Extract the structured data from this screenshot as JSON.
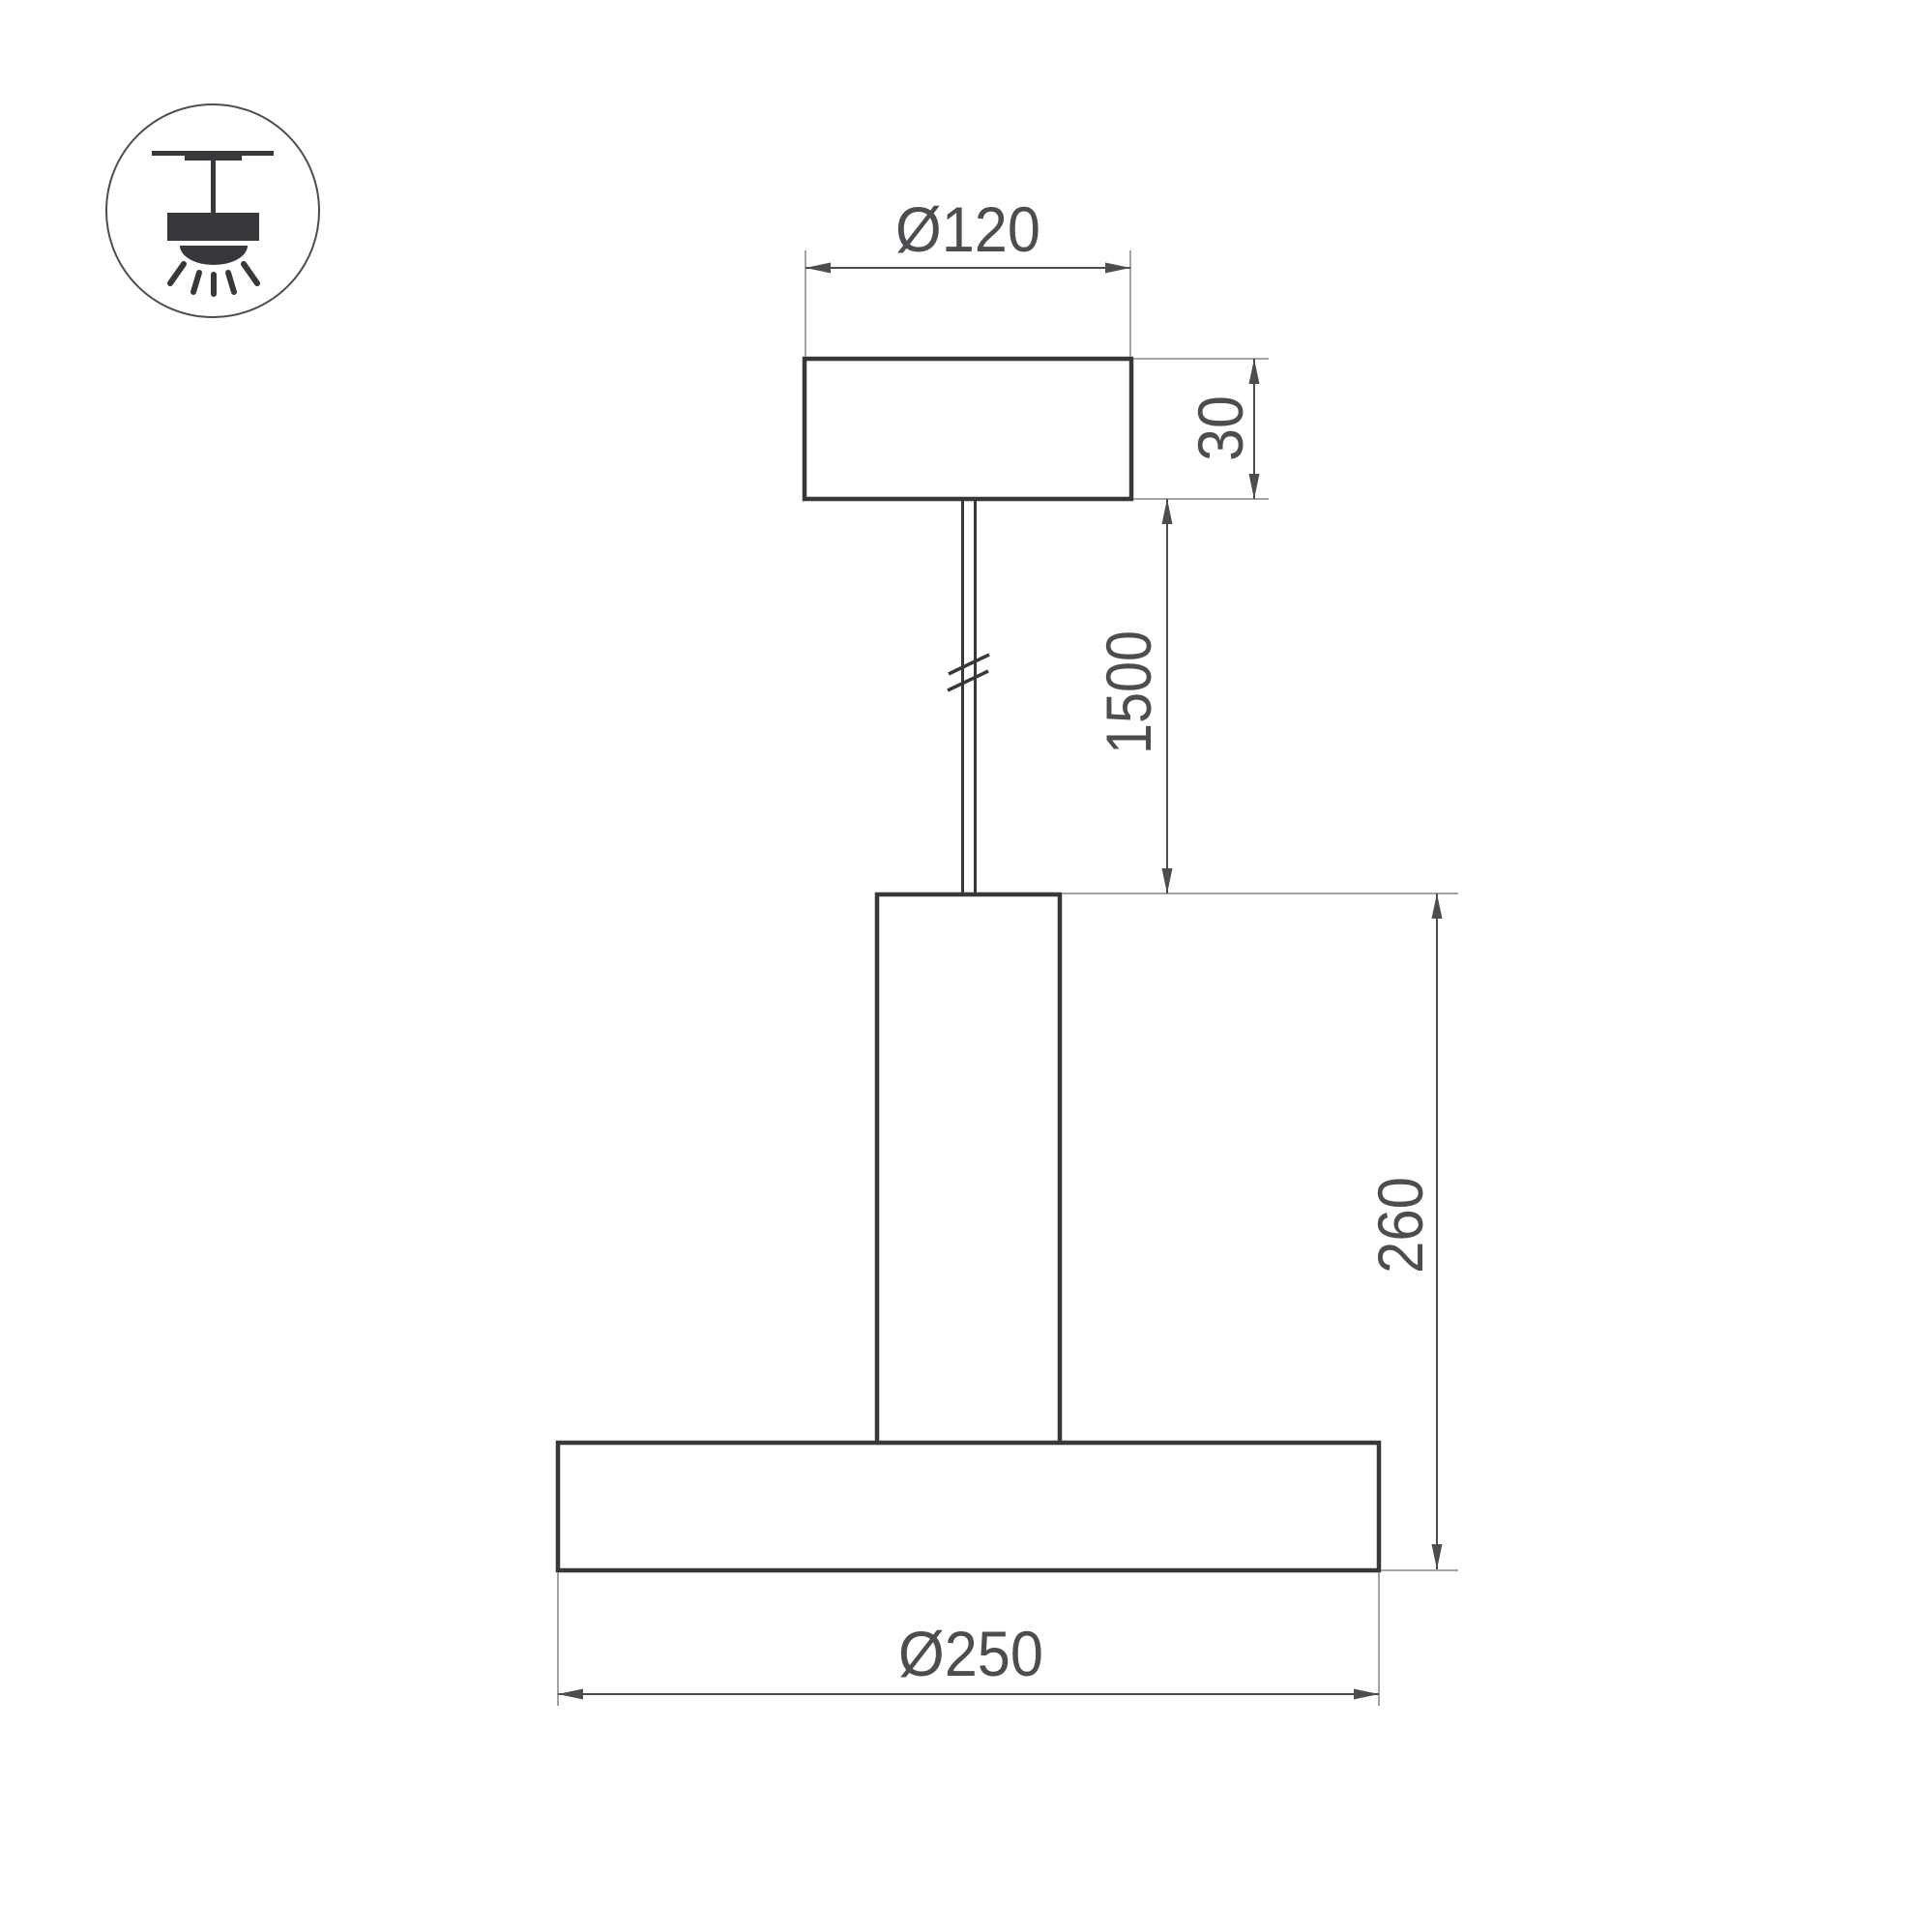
{
  "drawing": {
    "type": "technical-dimension-drawing",
    "product": "cylindrical pendant luminaire, front elevation",
    "units": "mm",
    "labels": {
      "canopy_diameter": "Ø120",
      "canopy_height": "30",
      "suspension_length": "1500",
      "body_height": "260",
      "shade_diameter": "Ø250"
    },
    "colors": {
      "background": "#ffffff",
      "object_line": "#36383b",
      "dimension_line": "#4b4d50",
      "extension_line": "#97999b",
      "text": "#4b4d50"
    }
  },
  "icon": {
    "name": "ceiling-pendant-mount-icon"
  }
}
